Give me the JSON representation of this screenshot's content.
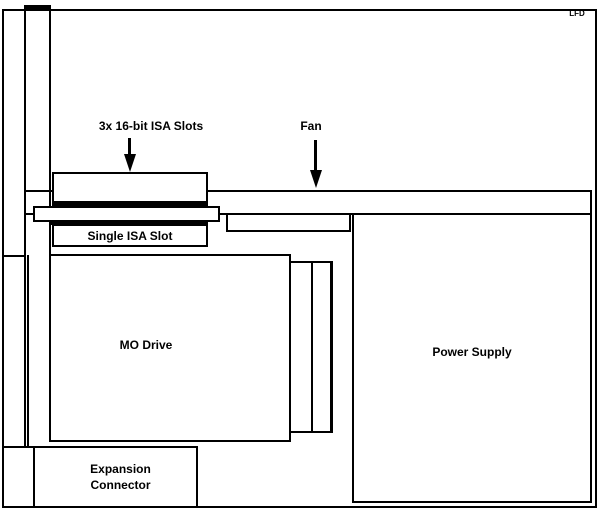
{
  "colors": {
    "background": "#ffffff",
    "line": "#000000"
  },
  "corner": {
    "label": "LFD"
  },
  "callouts": {
    "isa_slots": {
      "label": "3x 16-bit ISA Slots"
    },
    "fan": {
      "label": "Fan"
    }
  },
  "components": {
    "single_isa_slot": {
      "label": "Single ISA Slot"
    },
    "mo_drive": {
      "label": "MO Drive"
    },
    "power_supply": {
      "label": "Power Supply"
    },
    "expansion_connector": {
      "line1": "Expansion",
      "line2": "Connector"
    }
  }
}
